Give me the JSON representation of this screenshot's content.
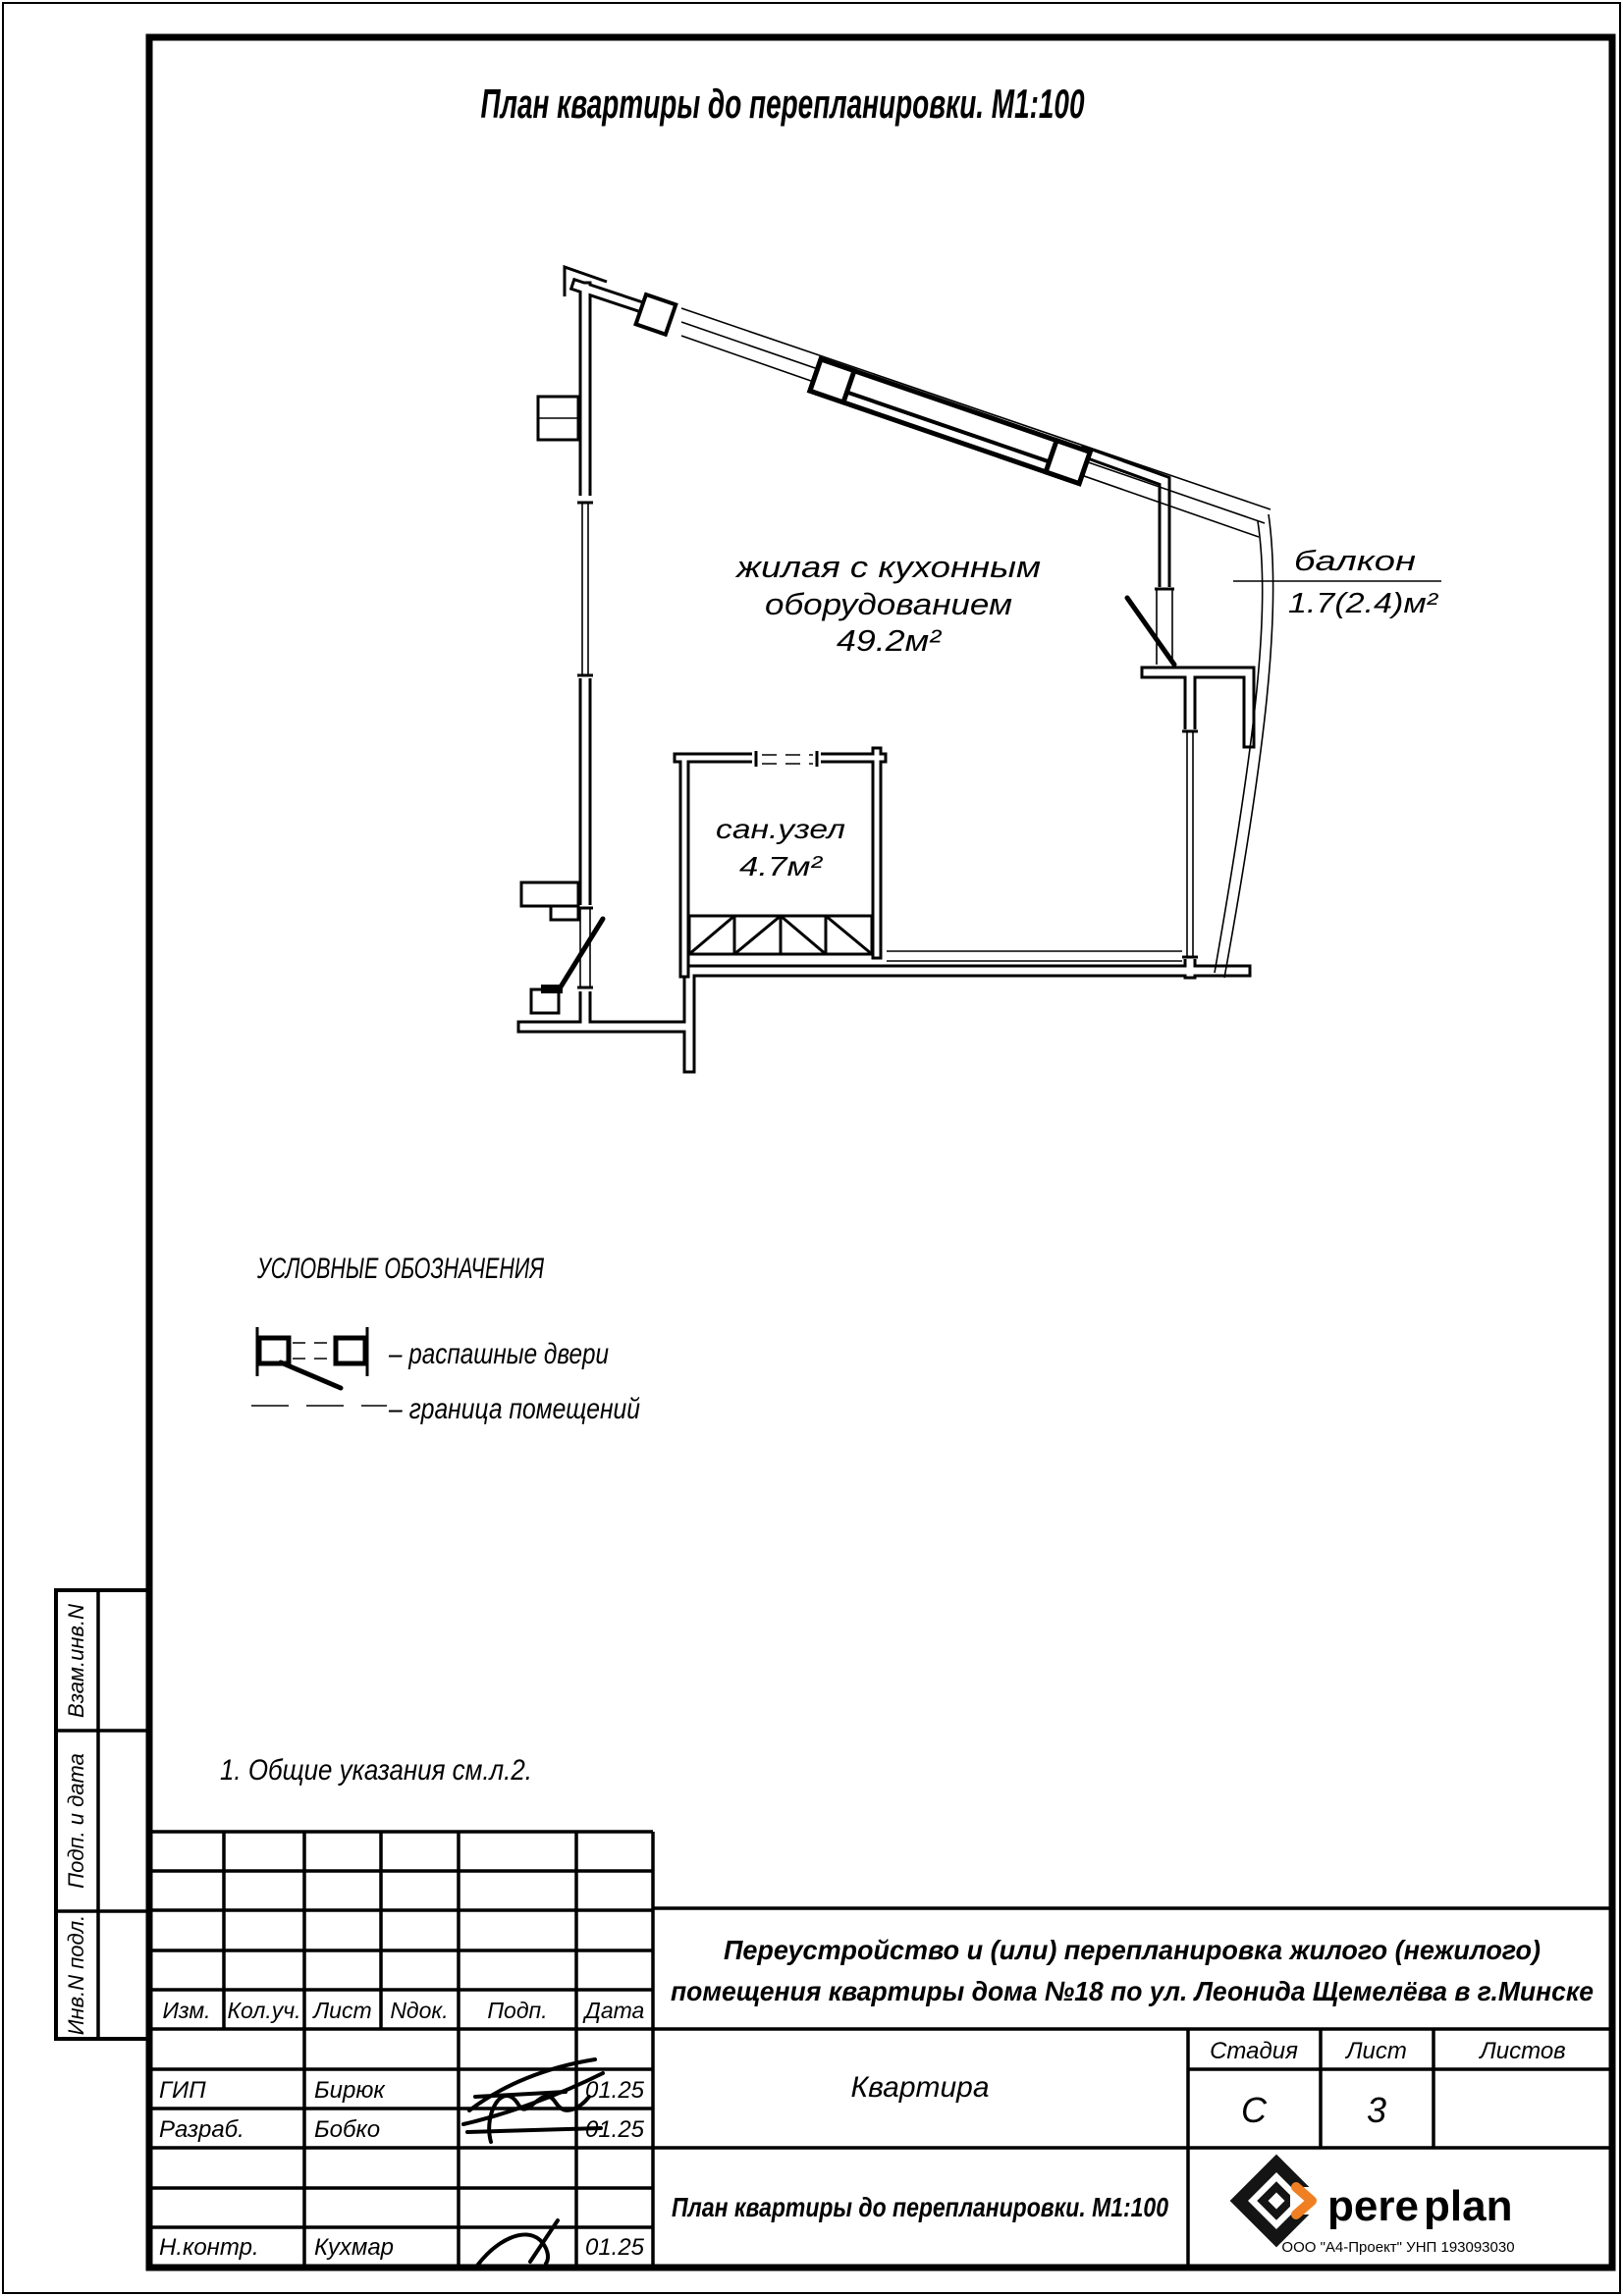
{
  "colors": {
    "accent": "#ef7f22",
    "ink": "#000000"
  },
  "title": "План квартиры до перепланировки. М1:100",
  "plan": {
    "room": {
      "line1": "жилая с кухонным",
      "line2": "оборудованием",
      "area": "49.2м²"
    },
    "bathroom": {
      "name": "сан.узел",
      "area": "4.7м²"
    },
    "balcony": {
      "name": "балкон",
      "area": "1.7(2.4)м²"
    }
  },
  "legend": {
    "heading": "УСЛОВНЫЕ ОБОЗНАЧЕНИЯ",
    "items": [
      {
        "symbol": "swing-doors",
        "label": "– распашные двери"
      },
      {
        "symbol": "room-boundary",
        "label": "– граница помещений"
      }
    ]
  },
  "note": "1. Общие указания см.л.2.",
  "side_strip": {
    "labels": [
      "Взам.инв.N",
      "Подп. и дата",
      "Инв.N подл."
    ]
  },
  "stamp": {
    "revision_headers": [
      "Изм.",
      "Кол.уч.",
      "Лист",
      "Nдок.",
      "Подп.",
      "Дата"
    ],
    "rows": [
      {
        "role": "ГИП",
        "name": "Бирюк",
        "date": "01.25"
      },
      {
        "role": "Разраб.",
        "name": "Бобко",
        "date": "01.25"
      },
      {
        "role": "Н.контр.",
        "name": "Кухмар",
        "date": "01.25"
      }
    ],
    "project_line1": "Переустройство и (или) перепланировка жилого (нежилого)",
    "project_line2": "помещения квартиры дома №18 по ул. Леонида Щемелёва в г.Минске",
    "object": "Квартира",
    "stage_label": "Стадия",
    "sheet_label": "Лист",
    "sheets_label": "Листов",
    "stage": "С",
    "sheet": "3",
    "drawing_name": "План квартиры до перепланировки. М1:100",
    "logo": {
      "black": "pere",
      "orange": "plan",
      "tagline": "ООО \"А4-Проект\" УНП 193093030"
    }
  }
}
